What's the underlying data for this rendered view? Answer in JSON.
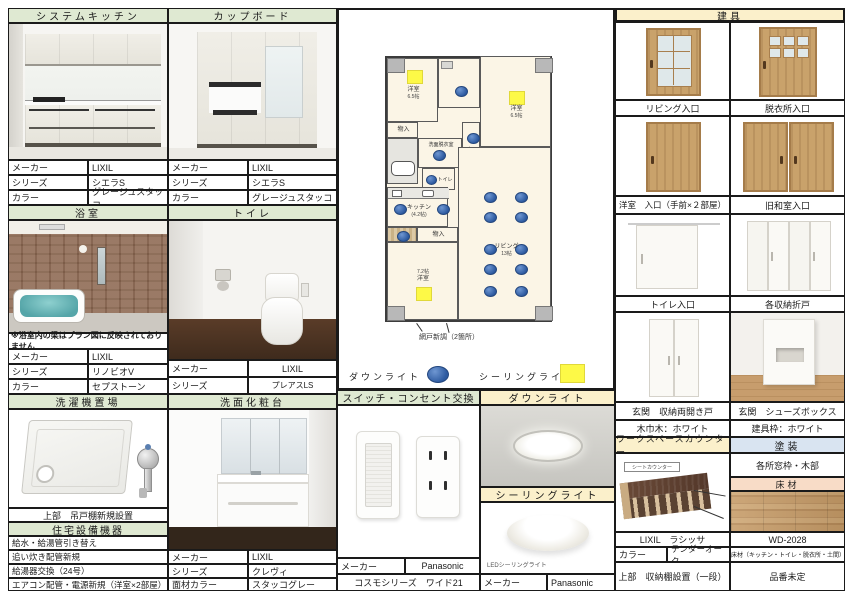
{
  "colors": {
    "header_green": "#dfe9d2",
    "header_cream": "#fbf0cb",
    "header_blue": "#d9e4f1",
    "header_peach": "#f8dcc7",
    "downlight_blue": "#2d5aa0",
    "ceiling_yellow": "#fdf947"
  },
  "kitchen": {
    "title": "システムキッチン",
    "rows": [
      [
        "メーカー",
        "LIXIL"
      ],
      [
        "シリーズ",
        "シエラS"
      ],
      [
        "カラー",
        "グレージュスタッコ"
      ]
    ]
  },
  "cupboard": {
    "title": "カップボード",
    "rows": [
      [
        "メーカー",
        "LIXIL"
      ],
      [
        "シリーズ",
        "シエラS"
      ],
      [
        "カラー",
        "グレージュスタッコ"
      ]
    ]
  },
  "bath": {
    "title": "浴室",
    "note": "※浴室内の梁はプラン図に反映されておりません",
    "rows": [
      [
        "メーカー",
        "LIXIL"
      ],
      [
        "シリーズ",
        "リノビオV"
      ],
      [
        "カラー",
        "セプストーン"
      ]
    ]
  },
  "toilet": {
    "title": "トイレ",
    "rows": [
      [
        "メーカー",
        "LIXIL"
      ],
      [
        "シリーズ",
        "プレアスLS"
      ]
    ]
  },
  "laundry": {
    "title": "洗濯機置場",
    "caption": "上部　吊戸棚新規設置"
  },
  "equipment": {
    "title": "住宅設備機器",
    "items": [
      "給水・給湯管引き替え",
      "追い炊き配管新規",
      "給湯器交換（24号）",
      "エアコン配管・電源新規（洋室×2部屋）"
    ]
  },
  "vanity": {
    "title": "洗面化粧台",
    "rows": [
      [
        "メーカー",
        "LIXIL"
      ],
      [
        "シリーズ",
        "クレヴィ"
      ],
      [
        "面材カラー",
        "スタッコグレー"
      ]
    ]
  },
  "switches": {
    "title": "スイッチ・コンセント交換",
    "maker_label": "メーカー",
    "maker": "Panasonic",
    "series": "コスモシリーズ　ワイド21"
  },
  "downlight": {
    "title": "ダウンライト"
  },
  "ceiling_light": {
    "title": "シーリングライト",
    "caption": "LEDシーリングライト",
    "maker_label": "メーカー",
    "maker": "Panasonic"
  },
  "fittings": {
    "title": "建具",
    "labels": [
      "リビング入口",
      "脱衣所入口",
      "洋室　入口（手前×２部屋）",
      "旧和室入口",
      "トイレ入口",
      "各収納折戸",
      "玄関　収納両開き戸",
      "玄関　シューズボックス"
    ],
    "baseboard": "木巾木：ホワイト",
    "frame": "建具枠：ホワイト"
  },
  "counter": {
    "title": "ワークスペースカウンター",
    "img_label": "シートカウンター",
    "product": "LIXIL　ラシッサ",
    "color_label": "カラー",
    "color_value": "テンダーオーク",
    "note": "上部　収納棚設置（一段）"
  },
  "paint": {
    "title": "塗装",
    "target": "各所窓枠・木部"
  },
  "flooring": {
    "title": "床材",
    "product": "WD-2028",
    "usage": "床材（キッチン・トイレ・脱衣所・土間）",
    "part_no": "品番未定"
  },
  "plan": {
    "legend_downlight": "ダウンライト",
    "legend_ceiling": "シーリングライト",
    "note": "網戸新調（2箇所）",
    "rooms": {
      "west1": "洋室",
      "west1_size": "6.5帖",
      "west2": "洋室",
      "west2_size": "6.5帖",
      "west3": "洋室",
      "west3_size": "7.2帖",
      "kitchen": "キッチン",
      "kitchen_size": "(4.2帖)",
      "living": "リビング",
      "living_size": "13帖",
      "washroom": "洗面脱衣室",
      "toilet": "トイレ",
      "hallway": "廊下",
      "closet": "物入"
    }
  }
}
